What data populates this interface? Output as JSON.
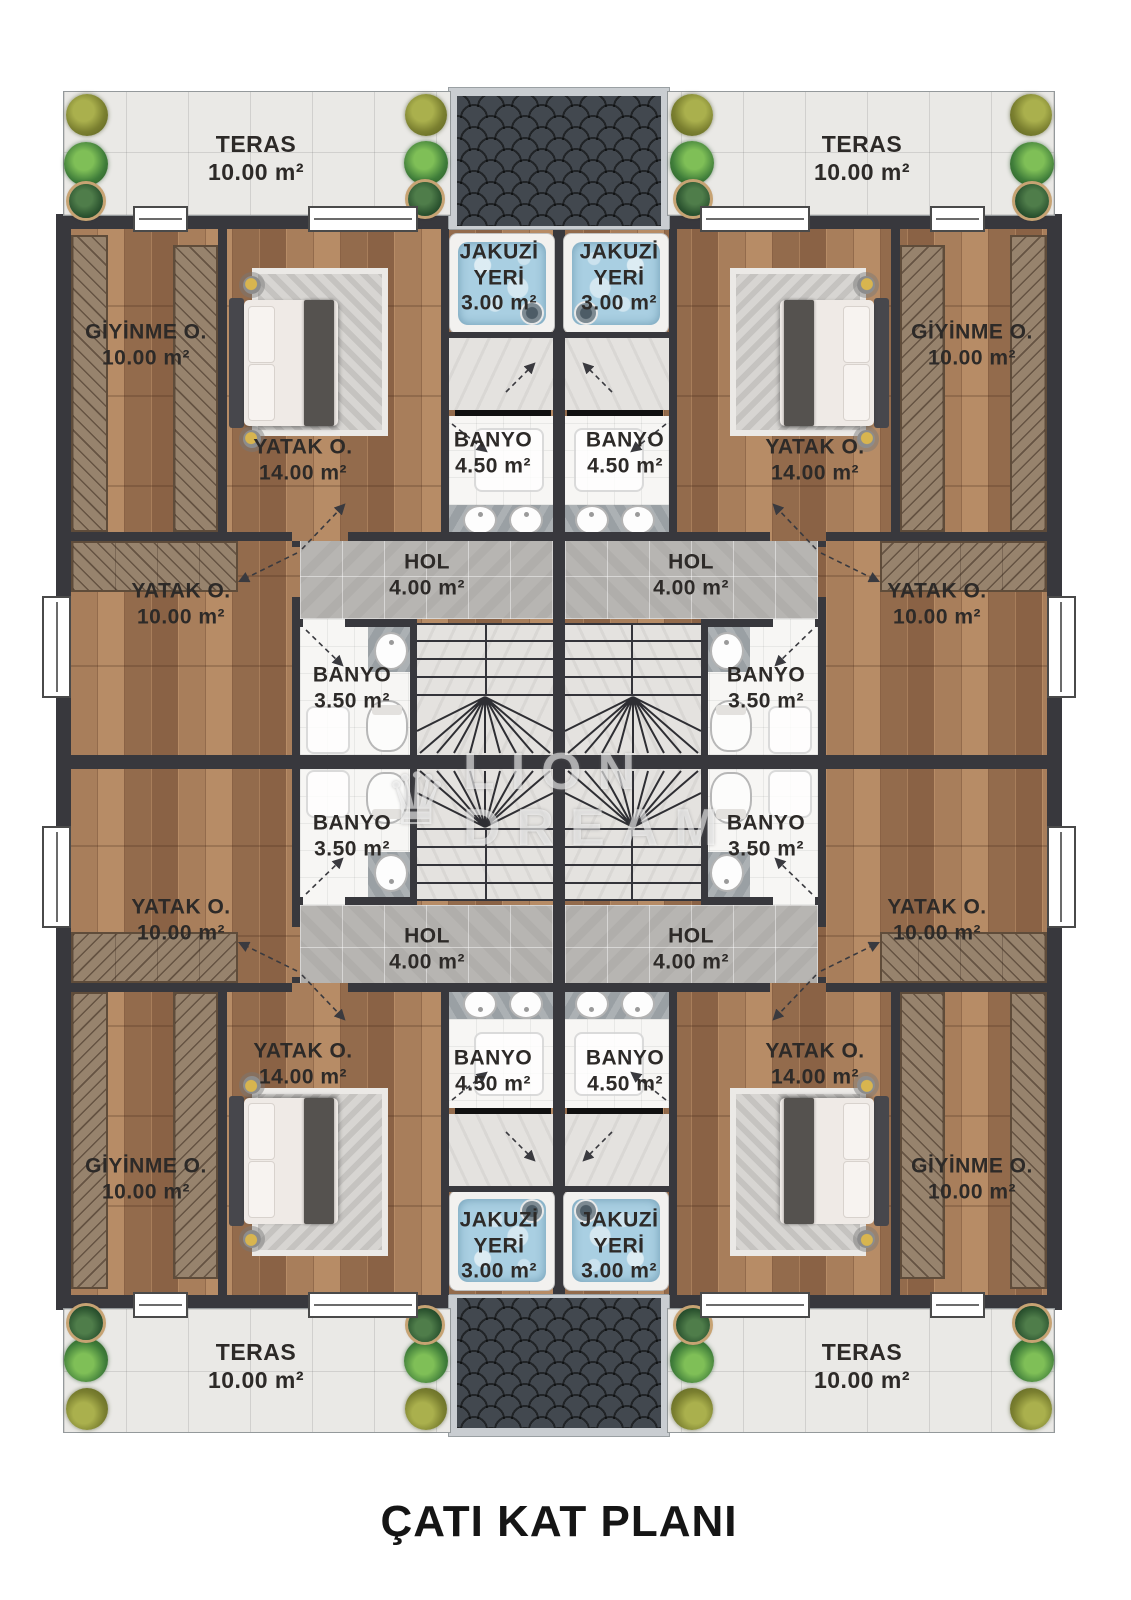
{
  "title": "ÇATI KAT PLANI",
  "watermark": {
    "icon": "crown-icon",
    "line1": "LION",
    "line2": "DREAM"
  },
  "rooms": {
    "teras": {
      "name": "TERAS",
      "area": "10.00 m²"
    },
    "giyinme": {
      "name": "GİYİNME O.",
      "area": "10.00 m²"
    },
    "yatak_buyuk": {
      "name": "YATAK O.",
      "area": "14.00 m²"
    },
    "jakuzi": {
      "line1": "JAKUZİ",
      "line2": "YERİ",
      "area": "3.00 m²"
    },
    "banyo_buyuk": {
      "name": "BANYO",
      "area": "4.50 m²"
    },
    "hol": {
      "name": "HOL",
      "area": "4.00 m²"
    },
    "banyo_kucuk": {
      "name": "BANYO",
      "area": "3.50 m²"
    },
    "yatak_kucuk": {
      "name": "YATAK O.",
      "area": "10.00 m²"
    }
  },
  "colors": {
    "wall": "#38383d",
    "wood1": "#a87e5b",
    "wood2": "#936b4c",
    "wood3": "#b78c66",
    "wood4": "#8a6245",
    "terrace": "#eae9e6",
    "holtile": "#b7b5b2",
    "marble": "#e4e2df",
    "bathtile": "#f7f6f4",
    "water": "#a9cfe2",
    "roof": "#42484f",
    "roofframe": "#c9cdd1",
    "rug14": "#d7d5d2",
    "rug10": "#b4bfbe",
    "label": "#2d2a28"
  }
}
